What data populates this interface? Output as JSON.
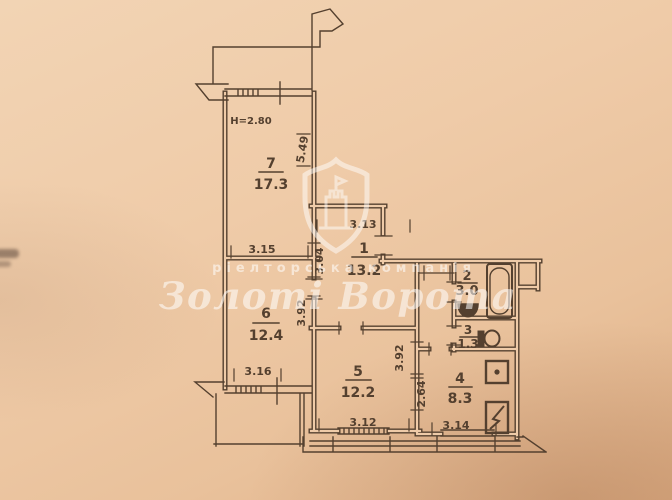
{
  "plan": {
    "ceiling_height_label": "H=2.80",
    "rooms": [
      {
        "number": "7",
        "area": "17.3"
      },
      {
        "number": "1",
        "area": "13.2"
      },
      {
        "number": "6",
        "area": "12.4"
      },
      {
        "number": "2",
        "area": "3.0"
      },
      {
        "number": "3",
        "area": "1.3"
      },
      {
        "number": "5",
        "area": "12.2"
      },
      {
        "number": "4",
        "area": "8.3"
      }
    ],
    "dimensions": {
      "room7_width": "3.15",
      "room7_depth": "5.49",
      "hall_width": "3.13",
      "hall_depth": "3.04",
      "room6_depth": "3.92",
      "room6_balcony_width": "3.16",
      "room5_width": "3.12",
      "room5_depth": "3.92",
      "kitchen_width": "3.14",
      "kitchen_depth": "2.64"
    },
    "fixtures": [
      "bathtub-icon",
      "wash-sink-icon",
      "toilet-icon",
      "stove-icon",
      "kitchen-sink-icon"
    ]
  },
  "watermark": {
    "tagline": "ріелторська компанія",
    "brand": "Золоті Ворота"
  },
  "colors": {
    "paper": "#efcba8",
    "ink": "#54402f",
    "watermark": "rgba(255,255,255,0.55)"
  }
}
